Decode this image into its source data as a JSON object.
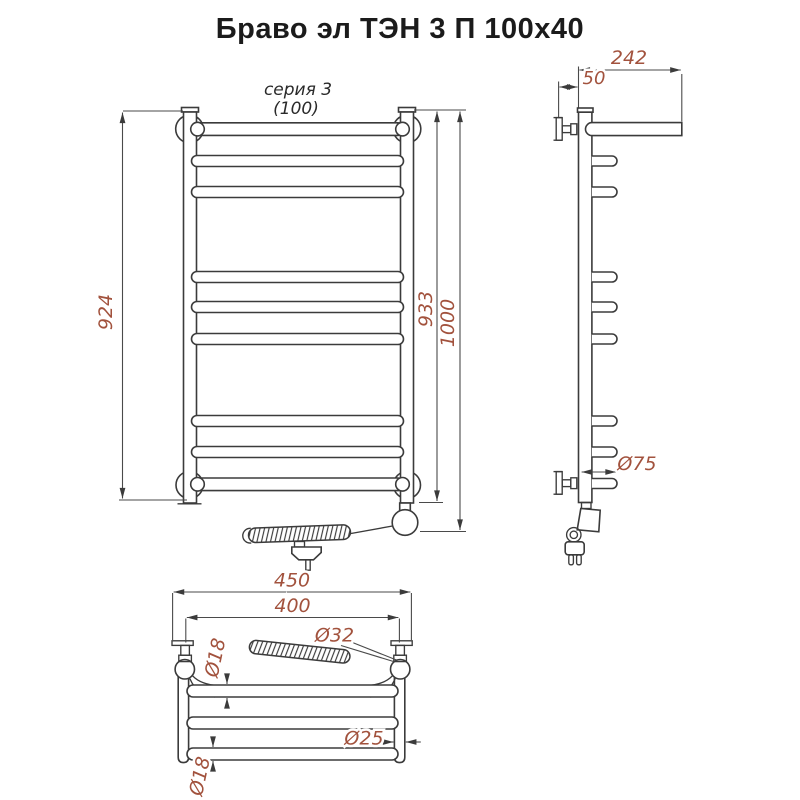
{
  "title": "Браво эл ТЭН 3 П 100x40",
  "colors": {
    "line": "#3b3b3b",
    "dimension_text": "#a2523d",
    "background": "#ffffff"
  },
  "front_view": {
    "series_label": "серия 3",
    "series_size": "(100)",
    "dim_rail_height": "924",
    "dim_collector_height": "933",
    "dim_total_height": "1000"
  },
  "side_view": {
    "dim_shelf_depth": "242",
    "dim_wall_offset": "50",
    "dim_bracket_length": "Ø75"
  },
  "bottom_view": {
    "dim_overall_width": "450",
    "dim_mount_width": "400",
    "dim_heater_diameter": "Ø32",
    "dim_collector_diameter": "Ø25",
    "dim_top_bar_diameter": "Ø18",
    "dim_bottom_bar_diameter": "Ø18"
  }
}
